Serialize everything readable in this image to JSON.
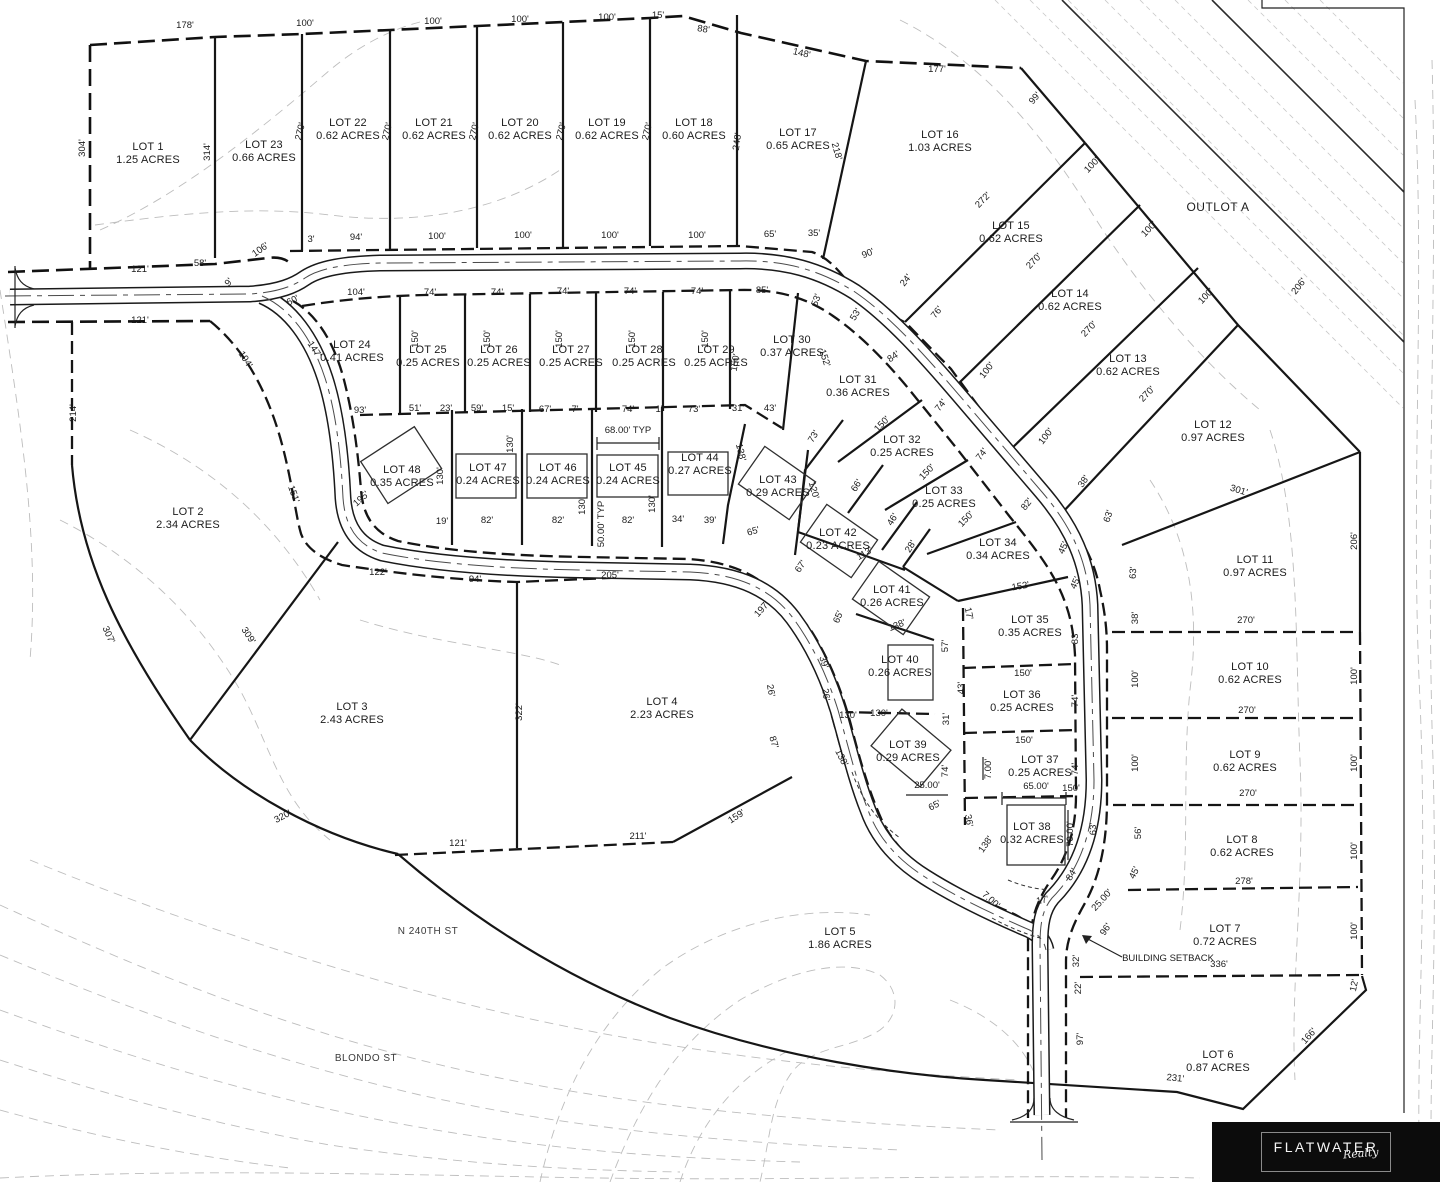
{
  "colors": {
    "ink": "#1b1b1b",
    "contour": "#bdbdbd",
    "road_center": "#4a4a4a",
    "logo_bg": "#0c0c0c",
    "paper": "#ffffff"
  },
  "logo": {
    "brand": "FLATWATER",
    "script": "Realty"
  },
  "annotations": [
    {
      "t": "OUTLOT A",
      "x": 1218,
      "y": 211,
      "r": 0,
      "c": "place"
    },
    {
      "t": "N 240TH ST",
      "x": 428,
      "y": 934,
      "r": 0,
      "c": "street"
    },
    {
      "t": "BLONDO ST",
      "x": 366,
      "y": 1061,
      "r": 0,
      "c": "street"
    },
    {
      "t": "BUILDING SETBACK",
      "x": 1168,
      "y": 961,
      "r": 0,
      "c": "note"
    },
    {
      "t": "68.00' TYP",
      "x": 628,
      "y": 433,
      "r": 0,
      "c": "note"
    },
    {
      "t": "50.00' TYP",
      "x": 604,
      "y": 524,
      "r": -90,
      "c": "note"
    }
  ],
  "lots": [
    {
      "n": "LOT 1",
      "a": "1.25 ACRES",
      "x": 148,
      "y": 150
    },
    {
      "n": "LOT 2",
      "a": "2.34 ACRES",
      "x": 188,
      "y": 515
    },
    {
      "n": "LOT 3",
      "a": "2.43 ACRES",
      "x": 352,
      "y": 710
    },
    {
      "n": "LOT 4",
      "a": "2.23 ACRES",
      "x": 662,
      "y": 705
    },
    {
      "n": "LOT 5",
      "a": "1.86 ACRES",
      "x": 840,
      "y": 935
    },
    {
      "n": "LOT 6",
      "a": "0.87 ACRES",
      "x": 1218,
      "y": 1058
    },
    {
      "n": "LOT 7",
      "a": "0.72 ACRES",
      "x": 1225,
      "y": 932
    },
    {
      "n": "LOT 8",
      "a": "0.62 ACRES",
      "x": 1242,
      "y": 843
    },
    {
      "n": "LOT 9",
      "a": "0.62 ACRES",
      "x": 1245,
      "y": 758
    },
    {
      "n": "LOT 10",
      "a": "0.62 ACRES",
      "x": 1250,
      "y": 670
    },
    {
      "n": "LOT 11",
      "a": "0.97 ACRES",
      "x": 1255,
      "y": 563
    },
    {
      "n": "LOT 12",
      "a": "0.97 ACRES",
      "x": 1213,
      "y": 428
    },
    {
      "n": "LOT 13",
      "a": "0.62 ACRES",
      "x": 1128,
      "y": 362
    },
    {
      "n": "LOT 14",
      "a": "0.62 ACRES",
      "x": 1070,
      "y": 297
    },
    {
      "n": "LOT 15",
      "a": "0.62 ACRES",
      "x": 1011,
      "y": 229
    },
    {
      "n": "LOT 16",
      "a": "1.03 ACRES",
      "x": 940,
      "y": 138
    },
    {
      "n": "LOT 17",
      "a": "0.65 ACRES",
      "x": 798,
      "y": 136
    },
    {
      "n": "LOT 18",
      "a": "0.60 ACRES",
      "x": 694,
      "y": 126
    },
    {
      "n": "LOT 19",
      "a": "0.62 ACRES",
      "x": 607,
      "y": 126
    },
    {
      "n": "LOT 20",
      "a": "0.62 ACRES",
      "x": 520,
      "y": 126
    },
    {
      "n": "LOT 21",
      "a": "0.62 ACRES",
      "x": 434,
      "y": 126
    },
    {
      "n": "LOT 22",
      "a": "0.62 ACRES",
      "x": 348,
      "y": 126
    },
    {
      "n": "LOT 23",
      "a": "0.66 ACRES",
      "x": 264,
      "y": 148
    },
    {
      "n": "LOT 24",
      "a": "0.41 ACRES",
      "x": 352,
      "y": 348
    },
    {
      "n": "LOT 25",
      "a": "0.25 ACRES",
      "x": 428,
      "y": 353
    },
    {
      "n": "LOT 26",
      "a": "0.25 ACRES",
      "x": 499,
      "y": 353
    },
    {
      "n": "LOT 27",
      "a": "0.25 ACRES",
      "x": 571,
      "y": 353
    },
    {
      "n": "LOT 28",
      "a": "0.25 ACRES",
      "x": 644,
      "y": 353
    },
    {
      "n": "LOT 29",
      "a": "0.25 ACRES",
      "x": 716,
      "y": 353
    },
    {
      "n": "LOT 30",
      "a": "0.37 ACRES",
      "x": 792,
      "y": 343
    },
    {
      "n": "LOT 31",
      "a": "0.36 ACRES",
      "x": 858,
      "y": 383
    },
    {
      "n": "LOT 32",
      "a": "0.25 ACRES",
      "x": 902,
      "y": 443
    },
    {
      "n": "LOT 33",
      "a": "0.25 ACRES",
      "x": 944,
      "y": 494
    },
    {
      "n": "LOT 34",
      "a": "0.34 ACRES",
      "x": 998,
      "y": 546
    },
    {
      "n": "LOT 35",
      "a": "0.35 ACRES",
      "x": 1030,
      "y": 623
    },
    {
      "n": "LOT 36",
      "a": "0.25 ACRES",
      "x": 1022,
      "y": 698
    },
    {
      "n": "LOT 37",
      "a": "0.25 ACRES",
      "x": 1040,
      "y": 763
    },
    {
      "n": "LOT 38",
      "a": "0.32 ACRES",
      "x": 1032,
      "y": 830
    },
    {
      "n": "LOT 39",
      "a": "0.29 ACRES",
      "x": 908,
      "y": 748
    },
    {
      "n": "LOT 40",
      "a": "0.26 ACRES",
      "x": 900,
      "y": 663
    },
    {
      "n": "LOT 41",
      "a": "0.26 ACRES",
      "x": 892,
      "y": 593
    },
    {
      "n": "LOT 42",
      "a": "0.23 ACRES",
      "x": 838,
      "y": 536
    },
    {
      "n": "LOT 43",
      "a": "0.29 ACRES",
      "x": 778,
      "y": 483
    },
    {
      "n": "LOT 44",
      "a": "0.27 ACRES",
      "x": 700,
      "y": 461
    },
    {
      "n": "LOT 45",
      "a": "0.24 ACRES",
      "x": 628,
      "y": 471
    },
    {
      "n": "LOT 46",
      "a": "0.24 ACRES",
      "x": 558,
      "y": 471
    },
    {
      "n": "LOT 47",
      "a": "0.24 ACRES",
      "x": 488,
      "y": 471
    },
    {
      "n": "LOT 48",
      "a": "0.35 ACRES",
      "x": 402,
      "y": 473
    }
  ],
  "dims": [
    [
      "178'",
      185,
      28,
      0
    ],
    [
      "100'",
      305,
      26,
      0
    ],
    [
      "100'",
      433,
      24,
      0
    ],
    [
      "100'",
      520,
      22,
      0
    ],
    [
      "100'",
      607,
      20,
      0
    ],
    [
      "15'",
      658,
      18,
      0
    ],
    [
      "88'",
      703,
      32,
      9
    ],
    [
      "148'",
      801,
      56,
      13
    ],
    [
      "177'",
      937,
      72,
      0
    ],
    [
      "99'",
      1037,
      100,
      -50
    ],
    [
      "304'",
      85,
      148,
      -90
    ],
    [
      "314'",
      210,
      152,
      -90
    ],
    [
      "270'",
      303,
      132,
      -76
    ],
    [
      "270'",
      390,
      132,
      -76
    ],
    [
      "270'",
      477,
      132,
      -76
    ],
    [
      "270'",
      564,
      132,
      -76
    ],
    [
      "270'",
      650,
      132,
      -76
    ],
    [
      "248'",
      740,
      142,
      -82
    ],
    [
      "218'",
      834,
      152,
      74
    ],
    [
      "121'",
      140,
      272,
      0
    ],
    [
      "58'",
      200,
      266,
      0
    ],
    [
      "9'",
      231,
      284,
      -50
    ],
    [
      "106'",
      262,
      252,
      -35
    ],
    [
      "3'",
      311,
      242,
      0
    ],
    [
      "94'",
      356,
      240,
      0
    ],
    [
      "100'",
      437,
      239,
      0
    ],
    [
      "100'",
      523,
      238,
      0
    ],
    [
      "100'",
      610,
      238,
      0
    ],
    [
      "100'",
      697,
      238,
      0
    ],
    [
      "65'",
      770,
      237,
      0
    ],
    [
      "35'",
      814,
      236,
      0
    ],
    [
      "90'",
      869,
      256,
      -22
    ],
    [
      "121'",
      140,
      323,
      0
    ],
    [
      "214'",
      76,
      413,
      -90
    ],
    [
      "194'",
      243,
      361,
      57
    ],
    [
      "60'",
      294,
      303,
      -27
    ],
    [
      "104'",
      356,
      295,
      0
    ],
    [
      "74'",
      430,
      295,
      0
    ],
    [
      "74'",
      497,
      295,
      0
    ],
    [
      "74'",
      563,
      294,
      0
    ],
    [
      "74'",
      630,
      294,
      0
    ],
    [
      "74'",
      697,
      294,
      0
    ],
    [
      "85'",
      762,
      293,
      0
    ],
    [
      "53'",
      819,
      301,
      -70
    ],
    [
      "53'",
      858,
      316,
      -58
    ],
    [
      "24'",
      908,
      282,
      -52
    ],
    [
      "76'",
      939,
      314,
      -52
    ],
    [
      "272'",
      985,
      202,
      -46
    ],
    [
      "100'",
      1094,
      167,
      -46
    ],
    [
      "270'",
      1036,
      263,
      -46
    ],
    [
      "100'",
      1151,
      231,
      -46
    ],
    [
      "270'",
      1091,
      331,
      -46
    ],
    [
      "100'",
      1208,
      298,
      -46
    ],
    [
      "270'",
      1149,
      396,
      -46
    ],
    [
      "206'",
      1301,
      288,
      -52
    ],
    [
      "152'",
      822,
      359,
      72
    ],
    [
      "84'",
      895,
      359,
      -34
    ],
    [
      "100'",
      989,
      372,
      -52
    ],
    [
      "74'",
      943,
      407,
      -52
    ],
    [
      "100'",
      1048,
      438,
      -52
    ],
    [
      "74'",
      984,
      456,
      -52
    ],
    [
      "38'",
      1086,
      483,
      -56
    ],
    [
      "82'",
      1029,
      506,
      -52
    ],
    [
      "63'",
      1111,
      517,
      -72
    ],
    [
      "45'",
      1066,
      549,
      -66
    ],
    [
      "45'",
      1078,
      584,
      -66
    ],
    [
      "38'",
      1138,
      618,
      -90
    ],
    [
      "63'",
      1136,
      573,
      -86
    ],
    [
      "150'",
      418,
      339,
      -90
    ],
    [
      "150'",
      490,
      339,
      -90
    ],
    [
      "150'",
      562,
      339,
      -90
    ],
    [
      "150'",
      635,
      339,
      -90
    ],
    [
      "150'",
      708,
      339,
      -90
    ],
    [
      "150'",
      738,
      363,
      -80
    ],
    [
      "147'",
      312,
      351,
      57
    ],
    [
      "93'",
      360,
      413,
      0
    ],
    [
      "51'",
      415,
      411,
      0
    ],
    [
      "23'",
      446,
      411,
      0
    ],
    [
      "59'",
      477,
      411,
      0
    ],
    [
      "15'",
      508,
      411,
      0
    ],
    [
      "67'",
      545,
      412,
      0
    ],
    [
      "7'",
      575,
      412,
      0
    ],
    [
      "74'",
      628,
      412,
      0
    ],
    [
      "1'",
      659,
      412,
      0
    ],
    [
      "73'",
      694,
      412,
      0
    ],
    [
      "31'",
      738,
      411,
      0
    ],
    [
      "43'",
      770,
      411,
      0
    ],
    [
      "73'",
      816,
      438,
      -58
    ],
    [
      "150'",
      884,
      426,
      -46
    ],
    [
      "66'",
      859,
      487,
      -58
    ],
    [
      "150'",
      929,
      474,
      -46
    ],
    [
      "46'",
      895,
      521,
      -58
    ],
    [
      "150'",
      968,
      521,
      -46
    ],
    [
      "28'",
      913,
      548,
      -58
    ],
    [
      "113'",
      866,
      556,
      -30
    ],
    [
      "120'",
      811,
      491,
      74
    ],
    [
      "138'",
      738,
      453,
      76
    ],
    [
      "130'",
      443,
      476,
      -90
    ],
    [
      "130'",
      513,
      444,
      -90
    ],
    [
      "130'",
      585,
      506,
      -90
    ],
    [
      "130'",
      655,
      504,
      -90
    ],
    [
      "19'",
      442,
      524,
      0
    ],
    [
      "82'",
      487,
      523,
      0
    ],
    [
      "82'",
      558,
      523,
      0
    ],
    [
      "82'",
      628,
      523,
      0
    ],
    [
      "34'",
      678,
      522,
      0
    ],
    [
      "39'",
      710,
      523,
      0
    ],
    [
      "65'",
      754,
      534,
      -16
    ],
    [
      "67'",
      803,
      568,
      -56
    ],
    [
      "65'",
      841,
      618,
      -68
    ],
    [
      "138'",
      898,
      628,
      -22
    ],
    [
      "197'",
      764,
      611,
      -48
    ],
    [
      "195'",
      363,
      501,
      -42
    ],
    [
      "151'",
      291,
      495,
      70
    ],
    [
      "122'",
      378,
      575,
      0
    ],
    [
      "94'",
      475,
      582,
      0
    ],
    [
      "205'",
      610,
      578,
      0
    ],
    [
      "309'",
      246,
      637,
      56
    ],
    [
      "307'",
      106,
      636,
      66
    ],
    [
      "320'",
      284,
      819,
      -28
    ],
    [
      "322'",
      522,
      712,
      -90
    ],
    [
      "121'",
      458,
      846,
      0
    ],
    [
      "211'",
      638,
      839,
      0
    ],
    [
      "159'",
      738,
      819,
      -33
    ],
    [
      "26'",
      768,
      691,
      80
    ],
    [
      "87'",
      771,
      743,
      73
    ],
    [
      "39'",
      821,
      663,
      73
    ],
    [
      "26'",
      823,
      695,
      82
    ],
    [
      "130'",
      848,
      718,
      0
    ],
    [
      "138'",
      839,
      759,
      63
    ],
    [
      "152'",
      1021,
      589,
      -10
    ],
    [
      "17'",
      966,
      614,
      78
    ],
    [
      "57'",
      948,
      646,
      -90
    ],
    [
      "43'",
      964,
      688,
      -90
    ],
    [
      "31'",
      949,
      719,
      -90
    ],
    [
      "74'",
      948,
      771,
      -90
    ],
    [
      "36'",
      966,
      821,
      80
    ],
    [
      "130'",
      879,
      716,
      0
    ],
    [
      "25.00'",
      927,
      788,
      0
    ],
    [
      "65'",
      936,
      808,
      -28
    ],
    [
      "83'",
      1078,
      638,
      -90
    ],
    [
      "150'",
      1023,
      676,
      0
    ],
    [
      "74'",
      1078,
      701,
      -90
    ],
    [
      "150'",
      1024,
      743,
      0
    ],
    [
      "74'",
      1078,
      769,
      -90
    ],
    [
      "150'",
      1071,
      791,
      0
    ],
    [
      "65.00'",
      1036,
      789,
      0
    ],
    [
      "7.00'",
      991,
      769,
      -90
    ],
    [
      "70.00'",
      1073,
      834,
      -90
    ],
    [
      "63'",
      1096,
      829,
      -90
    ],
    [
      "17'",
      1043,
      903,
      -12
    ],
    [
      "84'",
      1074,
      876,
      -58
    ],
    [
      "25.00'",
      1104,
      902,
      -48
    ],
    [
      "96'",
      1108,
      931,
      -55
    ],
    [
      "7.00'",
      989,
      902,
      42
    ],
    [
      "138'",
      988,
      846,
      -55
    ],
    [
      "32'",
      1079,
      961,
      -90
    ],
    [
      "22'",
      1081,
      988,
      -90
    ],
    [
      "97'",
      1083,
      1039,
      -90
    ],
    [
      "301'",
      1238,
      493,
      17
    ],
    [
      "206'",
      1357,
      541,
      -90
    ],
    [
      "270'",
      1246,
      623,
      0
    ],
    [
      "100'",
      1357,
      676,
      -90
    ],
    [
      "270'",
      1247,
      713,
      0
    ],
    [
      "100'",
      1138,
      679,
      -90
    ],
    [
      "100'",
      1138,
      763,
      -90
    ],
    [
      "270'",
      1248,
      796,
      0
    ],
    [
      "100'",
      1357,
      763,
      -90
    ],
    [
      "56'",
      1141,
      833,
      -90
    ],
    [
      "45'",
      1137,
      874,
      -64
    ],
    [
      "100'",
      1357,
      851,
      -90
    ],
    [
      "278'",
      1244,
      884,
      0
    ],
    [
      "100'",
      1357,
      931,
      -90
    ],
    [
      "336'",
      1219,
      967,
      0
    ],
    [
      "12'",
      1357,
      986,
      -78
    ],
    [
      "166'",
      1311,
      1038,
      -48
    ],
    [
      "231'",
      1175,
      1081,
      6
    ]
  ]
}
